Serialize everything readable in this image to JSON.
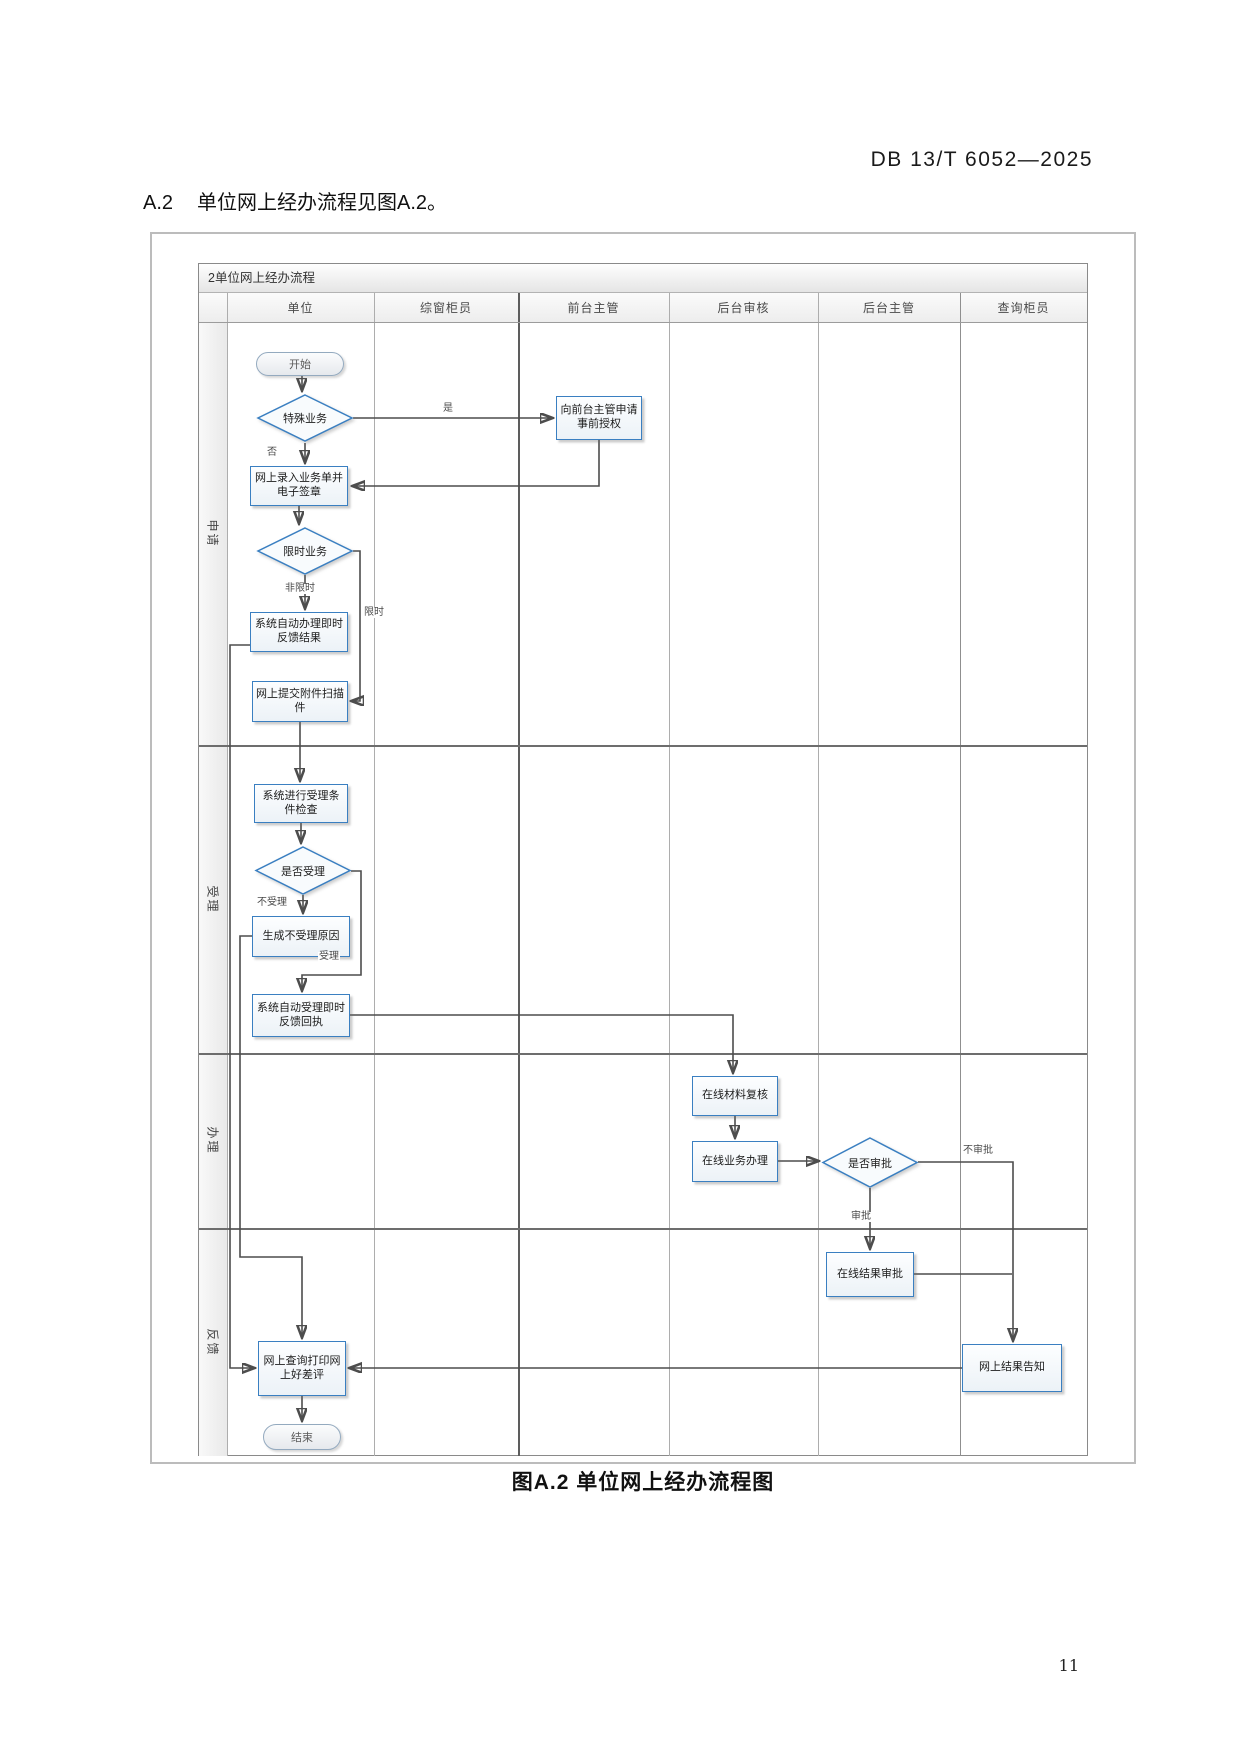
{
  "page": {
    "header_code": "DB 13/T 6052—2025",
    "section_number": "A.2",
    "section_text": "单位网上经办流程见图A.2。",
    "figure_caption": "图A.2 单位网上经办流程图",
    "page_number": "11"
  },
  "flowchart": {
    "window_title": "2单位网上经办流程",
    "columns": [
      "单位",
      "综窗柜员",
      "前台主管",
      "后台审核",
      "后台主管",
      "查询柜员"
    ],
    "stages": [
      "申请",
      "受理",
      "办理",
      "反馈"
    ],
    "nodes": {
      "start": "开始",
      "special_business": "特殊业务",
      "pre_auth": "向前台主管申请事前授权",
      "online_entry": "网上录入业务单并电子签章",
      "time_limited": "限时业务",
      "auto_process": "系统自动办理即时反馈结果",
      "submit_attachment": "网上提交附件扫描件",
      "accept_check": "系统进行受理条件检查",
      "accept_decision": "是否受理",
      "reject_reason": "生成不受理原因",
      "auto_accept": "系统自动受理即时反馈回执",
      "material_review": "在线材料复核",
      "online_handling": "在线业务办理",
      "approve_decision": "是否审批",
      "result_approve": "在线结果审批",
      "result_notify": "网上结果告知",
      "query_print": "网上查询打印网上好差评",
      "end": "结束"
    },
    "edge_labels": {
      "yes": "是",
      "no": "否",
      "not_time_limited": "非限时",
      "time_limited": "限时",
      "not_accepted": "不受理",
      "accepted": "受理",
      "approved": "审批",
      "not_approved": "不审批"
    },
    "colors": {
      "node_border": "#3a7fc1",
      "connector": "#4d4d4d"
    }
  }
}
